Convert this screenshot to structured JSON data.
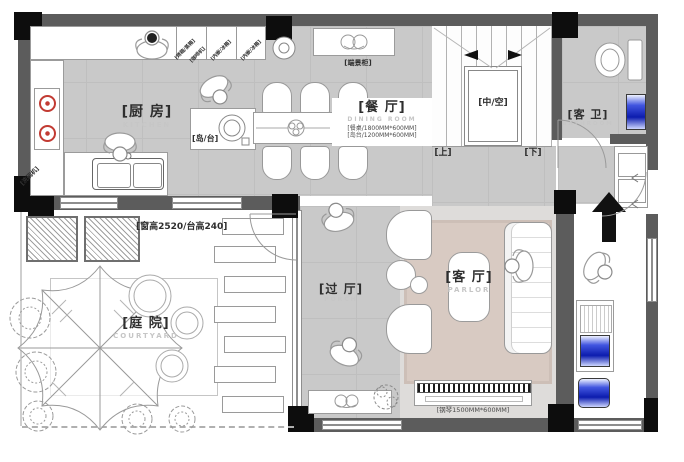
{
  "plan": {
    "rooms": {
      "kitchen": {
        "cn": "[厨 房]",
        "en": "KITCHEN"
      },
      "dining": {
        "cn": "[餐 厅]",
        "en": "DINING ROOM",
        "note_table": "[餐桌/1800MM*600MM]",
        "note_island": "[岛台/1200MM*600MM]"
      },
      "bathroom": {
        "cn": "[客 卫]",
        "en": "BATHROOM"
      },
      "hall": {
        "cn": "[过 厅]",
        "en": "PORCH"
      },
      "parlor": {
        "cn": "[客 厅]",
        "en": "PARLOR"
      },
      "courtyard": {
        "cn": "[庭 院]",
        "en": "COURTYARD"
      }
    },
    "stairs": {
      "void": "[中/空]",
      "up": "[上]",
      "down": "[下]"
    },
    "fixtures": {
      "island": "[岛/台]",
      "dishwasher": "[洗碗机]",
      "end_cabinet": "[端景柜]",
      "appliance_oven": "[烤箱/蒸箱]",
      "appliance_coffee": "[咖啡机]",
      "appliance_fridge_1": "[内嵌/冰箱]",
      "appliance_fridge_2": "[内嵌/冰箱]",
      "window_height_note": "[窗高2520/台高240]",
      "piano_note": "[钢琴1500MM*600MM]"
    },
    "colors": {
      "wall": "#5c5c5c",
      "column": "#0d0d0d",
      "floor_gray": "#c9c9c9",
      "rug": "#d8cac2",
      "accent_blue": "#2030d0",
      "burner_red": "#c23b33"
    }
  }
}
